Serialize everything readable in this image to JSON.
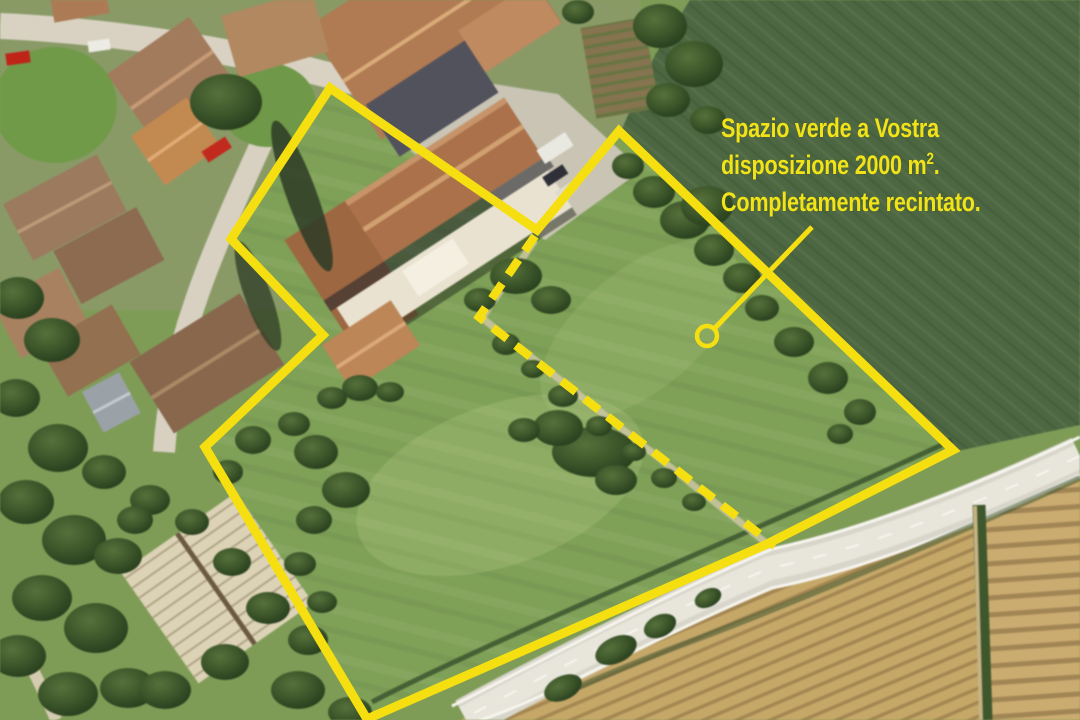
{
  "annotation": {
    "text": {
      "line1": "Spazio verde a Vostra",
      "line2_prefix": "disposizione 2000 m",
      "line2_sup": "2",
      "line2_suffix": ".",
      "line3": "Completamente recintato."
    },
    "colors": {
      "highlight_yellow": "#f6df10",
      "text_yellow": "#f2e319"
    },
    "boundary_points": "330,88 537,230 619,131 953,450 765,545 367,719 205,447 323,335 231,239",
    "divider_points": "535,236 479,317 775,546",
    "leader_points": "812,227 714,329",
    "marker": {
      "cx": "707",
      "cy": "336",
      "r": "10"
    }
  }
}
